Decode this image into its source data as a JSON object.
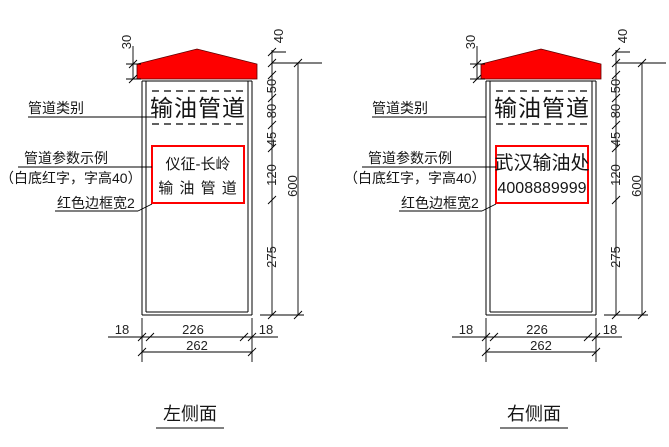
{
  "colors": {
    "red": "#fe0000",
    "line": "#000000",
    "background": "#ffffff"
  },
  "diagrams": {
    "left": {
      "title": "左侧面",
      "annotations": {
        "category_label": "管道类别",
        "param_label_line1": "管道参数示例",
        "param_label_line2": "（白底红字，字高40）",
        "border_label": "红色边框宽2"
      },
      "sign": {
        "category_text": "输油管道",
        "panel_line1": "仪征-长岭",
        "panel_line2": "输 油 管 道"
      },
      "dimensions": {
        "cap_height": "30",
        "seg_roof": "40",
        "seg_band": "50",
        "seg_category": "80",
        "seg_gap": "45",
        "seg_panel": "120",
        "seg_lower": "275",
        "overall_height": "600",
        "margin_left": "18",
        "inner_width": "226",
        "margin_right": "18",
        "overall_width": "262"
      }
    },
    "right": {
      "title": "右侧面",
      "annotations": {
        "category_label": "管道类别",
        "param_label_line1": "管道参数示例",
        "param_label_line2": "（白底红字，字高40）",
        "border_label": "红色边框宽2"
      },
      "sign": {
        "category_text": "输油管道",
        "panel_line1": "武汉输油处",
        "panel_line2": "4008889999"
      },
      "dimensions": {
        "cap_height": "30",
        "seg_roof": "40",
        "seg_band": "50",
        "seg_category": "80",
        "seg_gap": "45",
        "seg_panel": "120",
        "seg_lower": "275",
        "overall_height": "600",
        "margin_left": "18",
        "inner_width": "226",
        "margin_right": "18",
        "overall_width": "262"
      }
    }
  }
}
